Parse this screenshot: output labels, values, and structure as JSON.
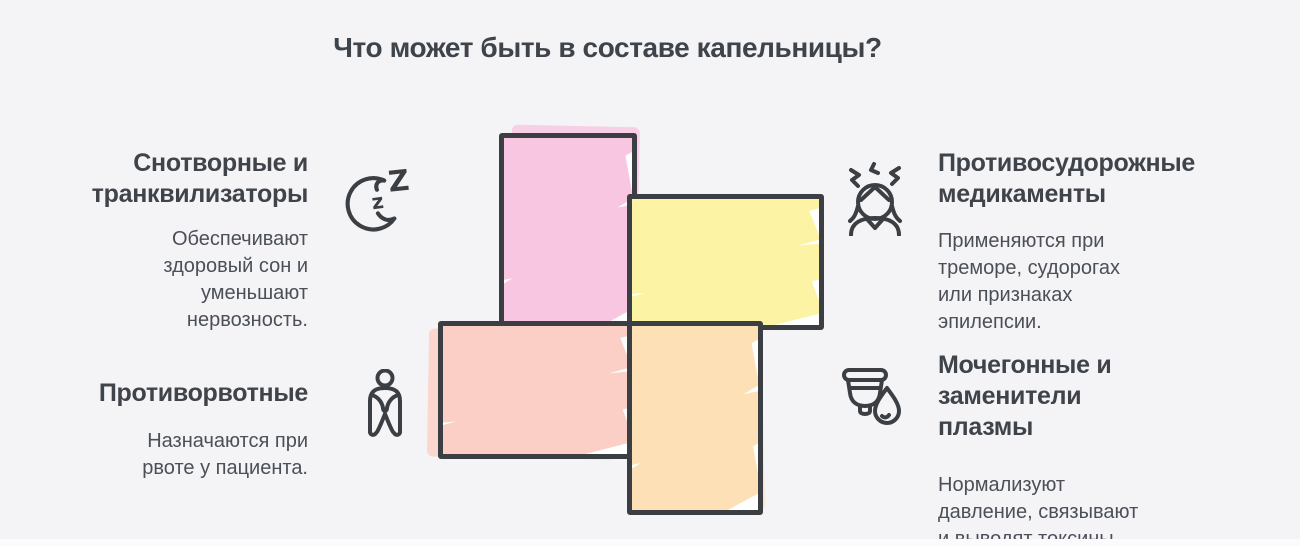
{
  "title": "Что может быть в составе капельницы?",
  "colors": {
    "background": "#f4f4f7",
    "stroke": "#3b3f44",
    "heading": "#3f434a",
    "body": "#4b4f57"
  },
  "items": [
    {
      "id": "sedatives",
      "icon": "moon-zzz-icon",
      "title": "Снотворные и\nтранквилизаторы",
      "description": "Обеспечивают\nздоровый сон и\nуменьшают\nнервозность.",
      "tile_color": "#f9c6e2"
    },
    {
      "id": "anticonvulsants",
      "icon": "stressed-person-icon",
      "title": "Противосудорожные\nмедикаменты",
      "description": "Применяются при\nтреморе, судорогах\nили признаках\nэпилепсии.",
      "tile_color": "#fcf3a4"
    },
    {
      "id": "antiemetics",
      "icon": "nauseous-person-icon",
      "title": "Противорвотные",
      "description": "Назначаются при\nрвоте у пациента.",
      "tile_color": "#fccfc6"
    },
    {
      "id": "plasma-diuretics",
      "icon": "cup-drop-icon",
      "title": "Мочегонные и\nзаменители\nплазмы",
      "description": "Нормализуют\nдавление, связывают\nи выводят токсины.",
      "tile_color": "#fde0b6"
    }
  ]
}
